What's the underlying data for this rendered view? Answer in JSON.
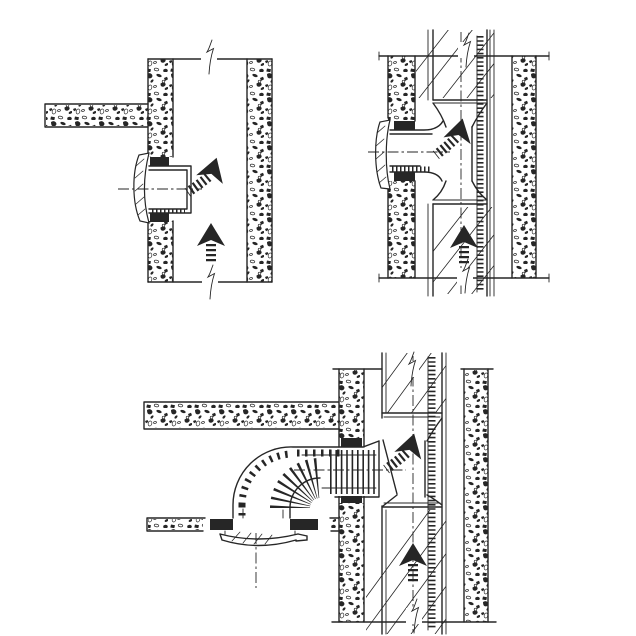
{
  "canvas": {
    "width": 636,
    "height": 636,
    "paper_color": "#ffffff",
    "ink_color": "#262626"
  },
  "figure": {
    "kind": "hand-drawn ink installation detail sketch: ventilation duct connections into a vertical shaft",
    "panels": [
      {
        "id": "top-left",
        "name": "duct-stub-with-cover-plate-through-wall-into-open-shaft"
      },
      {
        "id": "top-right",
        "name": "duct-with-cover-plate-into-lined-shaft-tee-connector"
      },
      {
        "id": "bottom",
        "name": "ceiling-valve-with-corrugated-elbow-duct-into-shaft-tee"
      }
    ]
  },
  "icons": {
    "curved_flow_arrow": "black dart arrowhead with ribbed tail curving up",
    "straight_flow_arrow": "black dart arrowhead with ribbed tail pointing up",
    "break_mark": "zigzag drawing break symbol",
    "center_axis_line": "dash-dot centre line"
  },
  "glyphs": {
    "curved_flow_arrows": [
      {
        "panel": "top-left",
        "x": 212,
        "y": 172,
        "rotate": 18
      },
      {
        "panel": "top-right",
        "x": 459,
        "y": 133,
        "rotate": 14
      },
      {
        "panel": "bottom",
        "x": 410,
        "y": 448,
        "rotate": 16
      }
    ],
    "straight_flow_arrows": [
      {
        "panel": "top-left",
        "x": 211,
        "y": 238
      },
      {
        "panel": "top-right",
        "x": 464,
        "y": 240
      },
      {
        "panel": "bottom",
        "x": 413,
        "y": 558
      }
    ],
    "break_marks": [
      {
        "panel": "top-left",
        "x": 209,
        "y": 40
      },
      {
        "panel": "top-left",
        "x": 210,
        "y": 265
      },
      {
        "panel": "top-right",
        "x": 466,
        "y": 33
      },
      {
        "panel": "top-right",
        "x": 465,
        "y": 259
      },
      {
        "panel": "bottom",
        "x": 411,
        "y": 352
      },
      {
        "panel": "bottom",
        "x": 414,
        "y": 599
      }
    ],
    "center_axis_lines": [
      {
        "panel": "top-left",
        "x1": 118,
        "y1": 189,
        "x2": 202,
        "y2": 189
      },
      {
        "panel": "top-right",
        "x1": 368,
        "y1": 152,
        "x2": 450,
        "y2": 152
      },
      {
        "panel": "top-right",
        "x1": 461,
        "y1": 32,
        "x2": 461,
        "y2": 294
      },
      {
        "panel": "bottom",
        "x1": 294,
        "y1": 470,
        "x2": 406,
        "y2": 470
      },
      {
        "panel": "bottom",
        "x1": 413,
        "y1": 356,
        "x2": 413,
        "y2": 632
      },
      {
        "panel": "bottom",
        "x1": 256,
        "y1": 533,
        "x2": 256,
        "y2": 588
      }
    ]
  }
}
